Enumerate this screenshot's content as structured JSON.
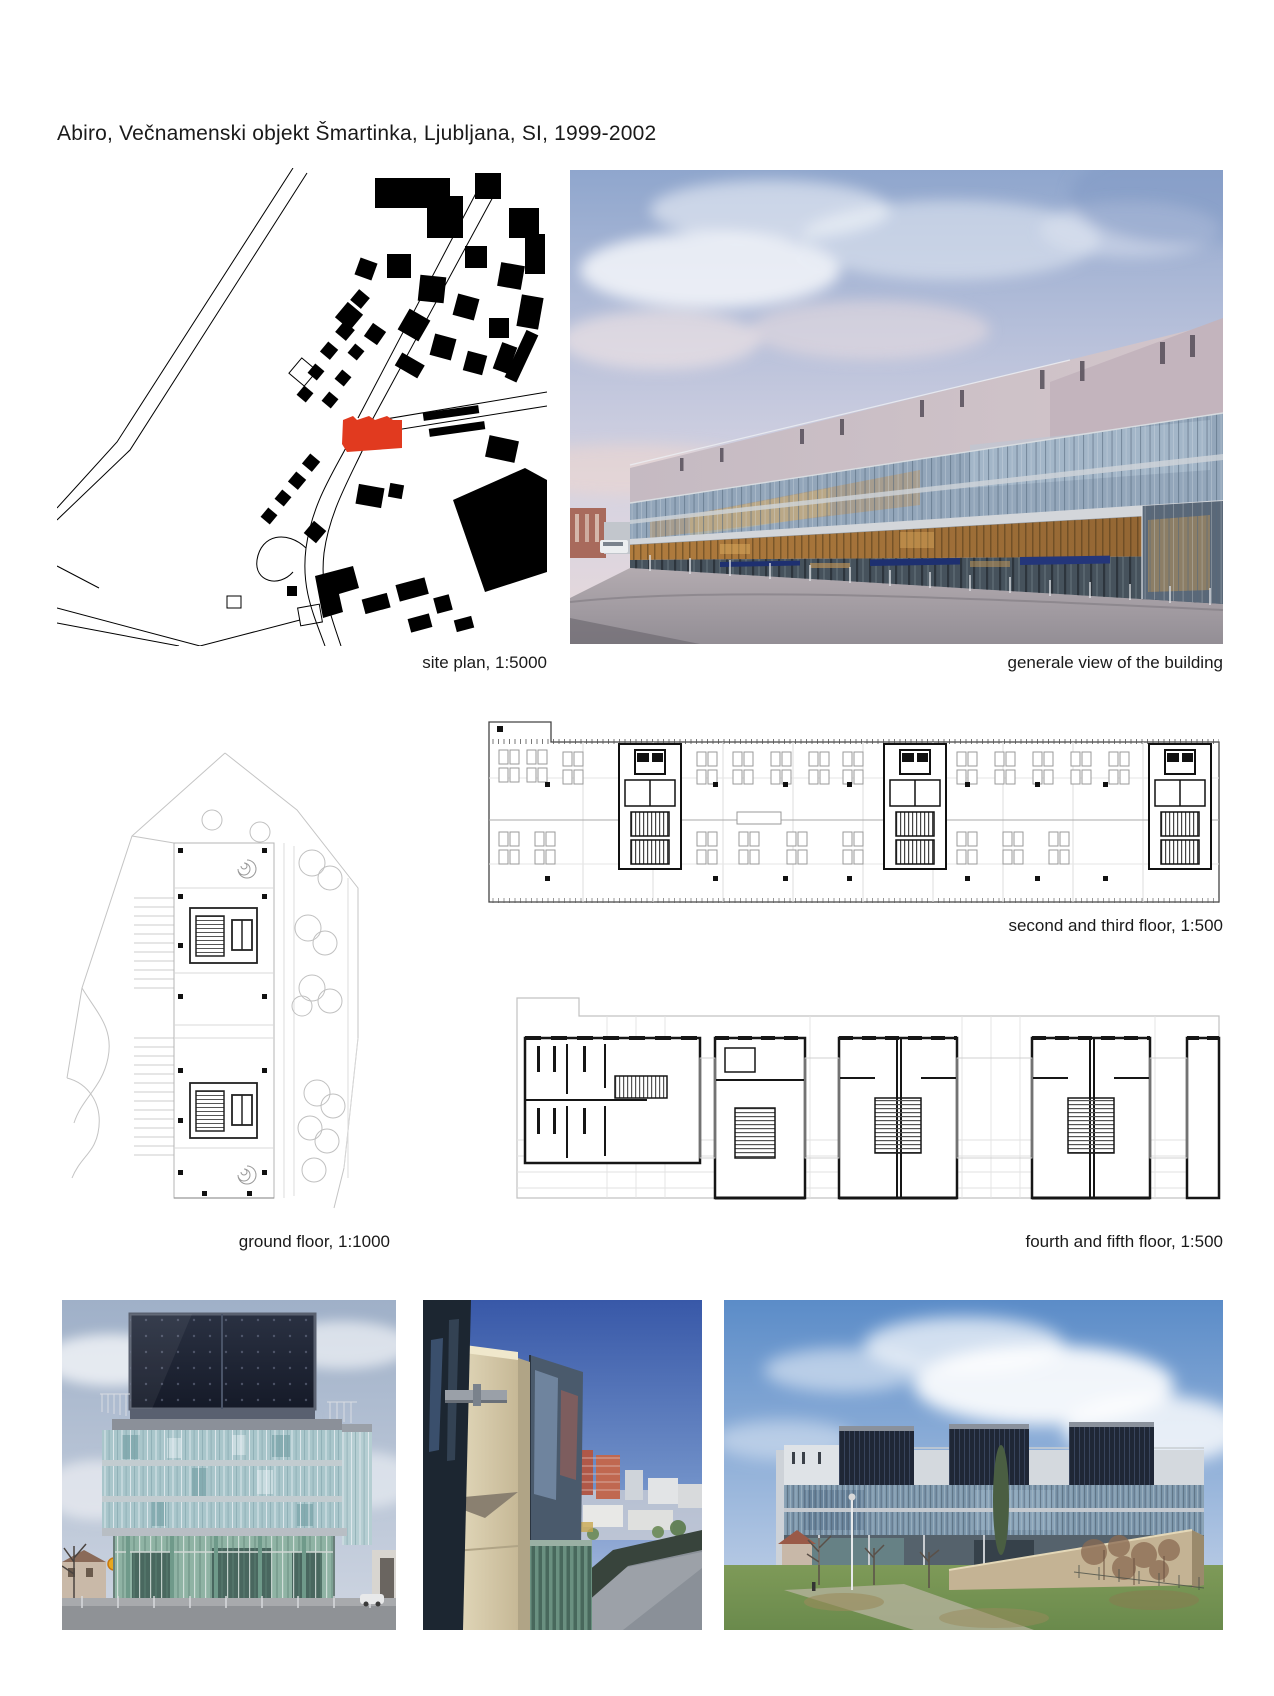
{
  "page": {
    "title": "Abiro, Večnamenski objekt Šmartinka, Ljubljana, SI, 1999-2002"
  },
  "captions": {
    "site_plan": "site plan, 1:5000",
    "general_view": "generale view of the building",
    "second_third_floor": "second and third floor, 1:500",
    "ground_floor": "ground floor, 1:1000",
    "fourth_fifth_floor": "fourth and fifth floor, 1:500"
  },
  "colors": {
    "highlight_red": "#e13a1f",
    "text": "#1a1a1a",
    "page_background": "#ffffff"
  }
}
